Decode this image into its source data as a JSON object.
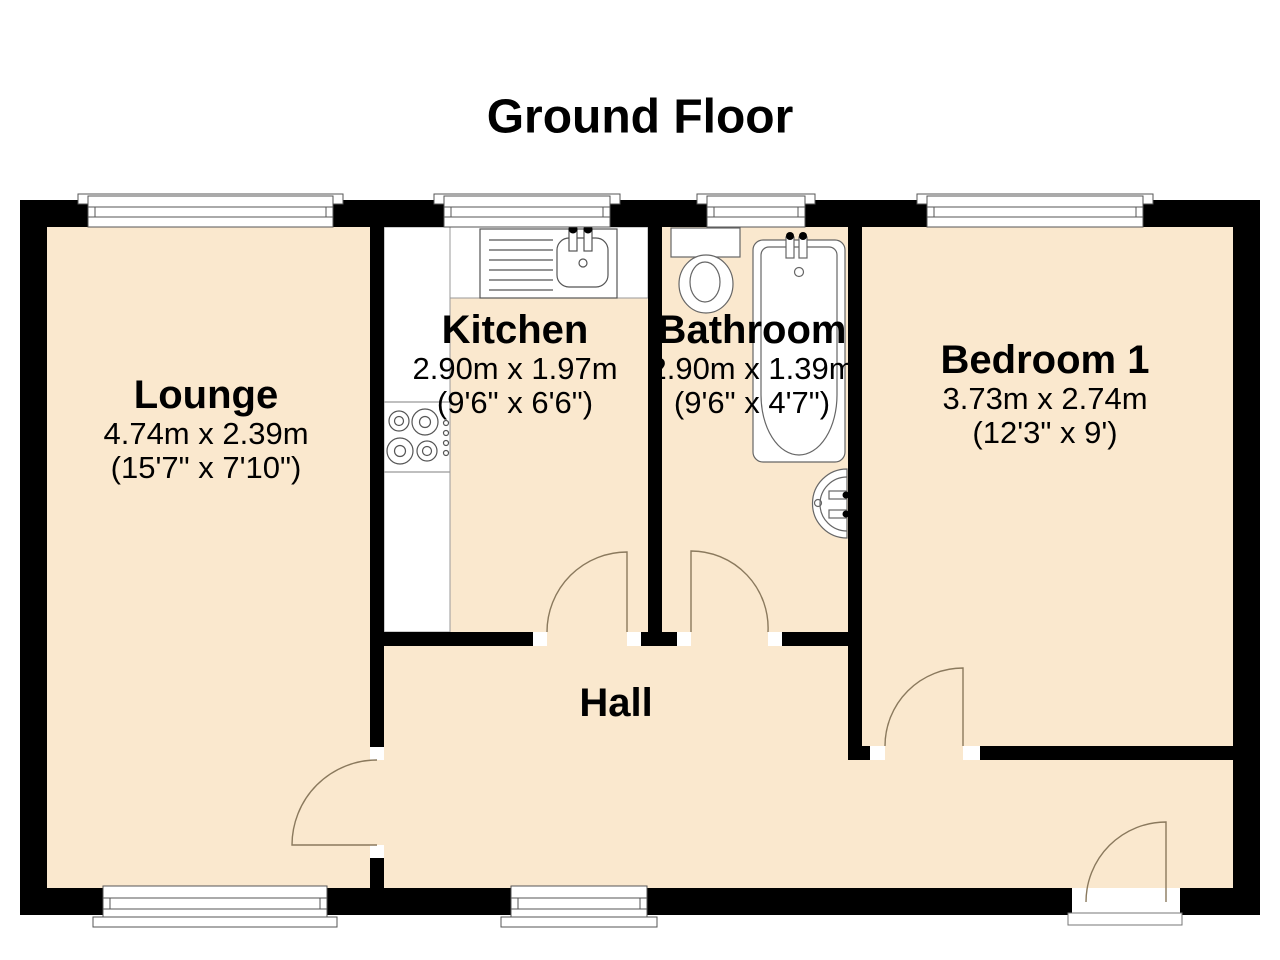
{
  "title": "Ground Floor",
  "rooms": {
    "lounge": {
      "name": "Lounge",
      "metric": "4.74m x 2.39m",
      "imperial": "(15'7\" x 7'10\")"
    },
    "kitchen": {
      "name": "Kitchen",
      "metric": "2.90m x 1.97m",
      "imperial": "(9'6\" x 6'6\")"
    },
    "bathroom": {
      "name": "Bathroom",
      "metric": "2.90m x 1.39m",
      "imperial": "(9'6\" x 4'7\")"
    },
    "bedroom1": {
      "name": "Bedroom 1",
      "metric": "3.73m x 2.74m",
      "imperial": "(12'3\" x 9')"
    },
    "hall": {
      "name": "Hall"
    }
  },
  "colors": {
    "floor": "#FAE8CE",
    "wall": "#000000",
    "door_swing": "#8A795D",
    "fixture_outline": "#666666",
    "window_outline": "#555555",
    "text": "#000000"
  },
  "fixtures": [
    "kitchen-sink",
    "kitchen-hob",
    "toilet",
    "bathtub",
    "wash-basin"
  ],
  "openings": {
    "windows_top": 4,
    "windows_bottom": 2,
    "interior_doors": 4,
    "entrance_doors": 1
  }
}
